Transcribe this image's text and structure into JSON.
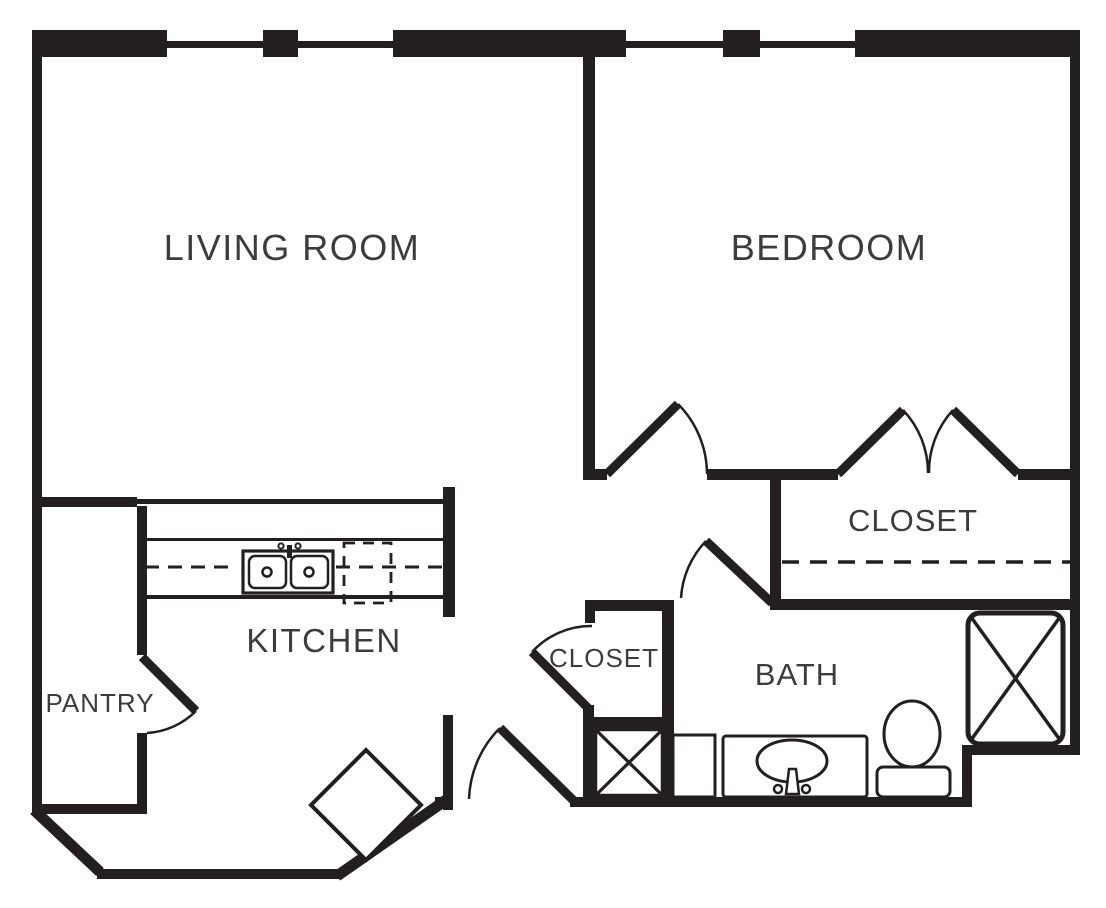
{
  "title": "One-bedroom apartment floor plan",
  "colors": {
    "wall": "#231f20",
    "label": "#3c3c3c",
    "background": "#ffffff"
  },
  "rooms": {
    "living_room": {
      "label": "LIVING ROOM"
    },
    "bedroom": {
      "label": "BEDROOM"
    },
    "bedroom_closet": {
      "label": "CLOSET"
    },
    "hall_closet": {
      "label": "CLOSET"
    },
    "kitchen": {
      "label": "KITCHEN"
    },
    "pantry": {
      "label": "PANTRY"
    },
    "bath": {
      "label": "BATH"
    }
  },
  "fixtures": {
    "kitchen_sink": "double-basin-sink",
    "dishwasher": "dashed-appliance-outline",
    "counter_rod": "dashed-cabinet-line",
    "closet_rod": "dashed-closet-rod",
    "utility_box": "x-box-utility",
    "linen_box": "x-box-shelving",
    "vanity_sink": "oval-basin-with-faucet",
    "toilet": "toilet-tank-and-bowl",
    "dining_column": "rotated-square-feature",
    "windows": [
      "window-segment",
      "window-segment",
      "window-segment",
      "window-segment"
    ],
    "doors": [
      "bedroom-door",
      "closet-double-door-left",
      "closet-double-door-right",
      "bath-door",
      "hall-closet-door",
      "pantry-door",
      "entry-door"
    ]
  }
}
